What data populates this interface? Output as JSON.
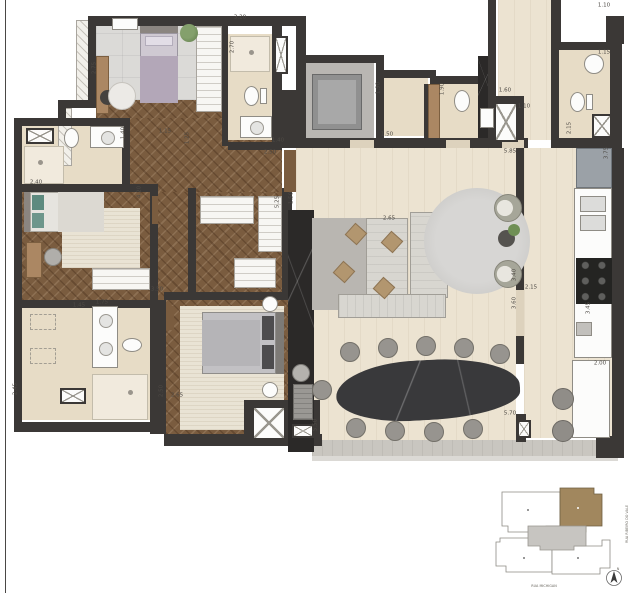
{
  "plan": {
    "palette": {
      "wall": "#3b3836",
      "wood_floor": "#7a5c3f",
      "beige_floor": "#ece3d1",
      "marble": "#2b2928",
      "rug_gray": "#dbdad7",
      "rug_cream": "#e9e3d4",
      "keyplan_highlight": "#a1875e"
    },
    "dimensions": [
      {
        "t": "3.20",
        "x": 240,
        "y": 18,
        "v": false
      },
      {
        "t": "2.75",
        "x": 95,
        "y": 68,
        "v": true
      },
      {
        "t": "2.70",
        "x": 233,
        "y": 47,
        "v": true
      },
      {
        "t": "1.40",
        "x": 278,
        "y": 141,
        "v": false
      },
      {
        "t": "2.50",
        "x": 270,
        "y": 153,
        "v": false
      },
      {
        "t": "1.15",
        "x": 165,
        "y": 132,
        "v": false
      },
      {
        "t": "1.40",
        "x": 124,
        "y": 133,
        "v": true
      },
      {
        "t": "1.25",
        "x": 188,
        "y": 138,
        "v": true
      },
      {
        "t": "2.40",
        "x": 36,
        "y": 183,
        "v": false
      },
      {
        "t": "4.20",
        "x": 140,
        "y": 192,
        "v": true
      },
      {
        "t": "1.90",
        "x": 379,
        "y": 88,
        "v": true
      },
      {
        "t": "1.50",
        "x": 387,
        "y": 135,
        "v": false
      },
      {
        "t": "1.90",
        "x": 443,
        "y": 89,
        "v": true
      },
      {
        "t": "1.60",
        "x": 505,
        "y": 91,
        "v": false
      },
      {
        "t": "1.10",
        "x": 524,
        "y": 107,
        "v": false
      },
      {
        "t": "1.10",
        "x": 604,
        "y": 6,
        "v": false
      },
      {
        "t": "1.15",
        "x": 604,
        "y": 53,
        "v": false
      },
      {
        "t": "2.15",
        "x": 570,
        "y": 128,
        "v": true
      },
      {
        "t": "3.75",
        "x": 607,
        "y": 153,
        "v": true
      },
      {
        "t": "5.85",
        "x": 510,
        "y": 152,
        "v": false
      },
      {
        "t": "3.50",
        "x": 157,
        "y": 290,
        "v": false
      },
      {
        "t": "1.45",
        "x": 79,
        "y": 306,
        "v": false
      },
      {
        "t": "1.75",
        "x": 102,
        "y": 303,
        "v": false
      },
      {
        "t": "5.25",
        "x": 278,
        "y": 202,
        "v": true
      },
      {
        "t": "1.50",
        "x": 292,
        "y": 198,
        "v": true
      },
      {
        "t": "2.65",
        "x": 389,
        "y": 219,
        "v": false
      },
      {
        "t": "3.40",
        "x": 515,
        "y": 275,
        "v": true
      },
      {
        "t": "3.60",
        "x": 515,
        "y": 303,
        "v": true
      },
      {
        "t": "2.15",
        "x": 531,
        "y": 288,
        "v": false
      },
      {
        "t": "3.45",
        "x": 589,
        "y": 308,
        "v": true
      },
      {
        "t": "2.00",
        "x": 600,
        "y": 364,
        "v": false
      },
      {
        "t": "2.45",
        "x": 16,
        "y": 389,
        "v": true
      },
      {
        "t": "2.50",
        "x": 162,
        "y": 391,
        "v": true
      },
      {
        "t": "2.65",
        "x": 177,
        "y": 396,
        "v": false
      },
      {
        "t": "5.50",
        "x": 316,
        "y": 425,
        "v": true
      },
      {
        "t": "5.70",
        "x": 510,
        "y": 414,
        "v": false
      }
    ]
  },
  "keyplan": {
    "street_right": "RUA RIBEIRO DO VALE",
    "street_bottom": "RUA MICHIGAN",
    "north_label": "N"
  }
}
